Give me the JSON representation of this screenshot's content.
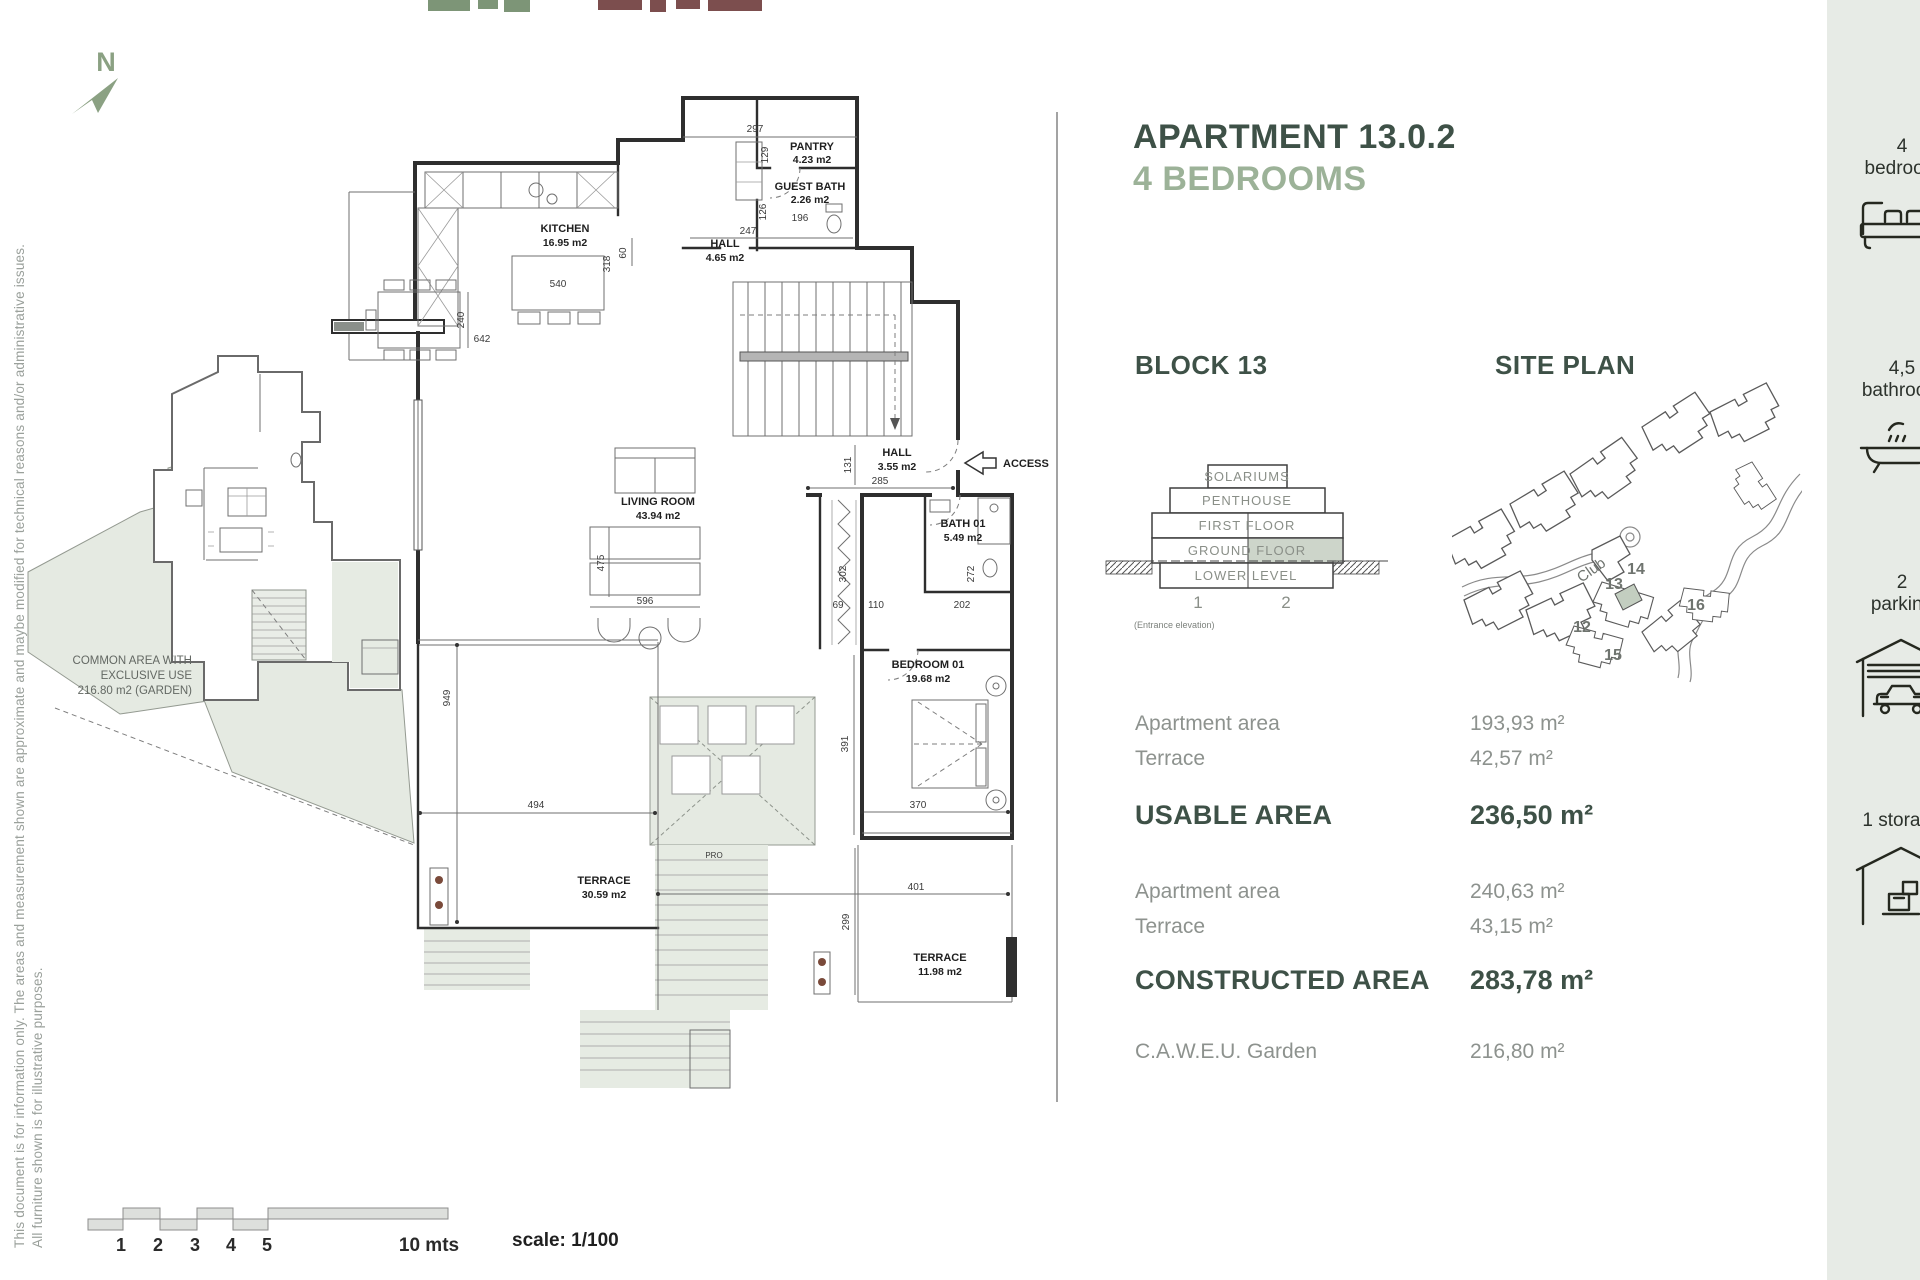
{
  "page": {
    "disclaimer_line1": "This document is for information only. The areas and measurement shown are approximate and maybe modified for technical reasons and/or administrative issues.",
    "disclaimer_line2": "All furniture shown is for illustrative purposes.",
    "compass_label": "N"
  },
  "header": {
    "title": "APARTMENT 13.0.2",
    "subtitle": "4 BEDROOMS"
  },
  "plan": {
    "rooms": [
      {
        "name": "PANTRY",
        "area": "4.23 m2"
      },
      {
        "name": "GUEST BATH",
        "area": "2.26 m2"
      },
      {
        "name": "KITCHEN",
        "area": "16.95 m2"
      },
      {
        "name": "HALL",
        "area": "4.65 m2"
      },
      {
        "name": "HALL",
        "area": "3.55 m2"
      },
      {
        "name": "LIVING ROOM",
        "area": "43.94 m2"
      },
      {
        "name": "BATH 01",
        "area": "5.49 m2"
      },
      {
        "name": "BEDROOM 01",
        "area": "19.68 m2"
      },
      {
        "name": "TERRACE",
        "area": "30.59 m2"
      },
      {
        "name": "TERRACE",
        "area": "11.98 m2"
      }
    ],
    "common_area": {
      "line1": "COMMON AREA WITH",
      "line2": "EXCLUSIVE USE",
      "line3": "216.80 m2 (GARDEN)"
    },
    "access_label": "ACCESS",
    "stair_label": "PRO",
    "dims": {
      "d297": "297",
      "d129": "129",
      "d126": "126",
      "d196": "196",
      "d247": "247",
      "d60": "60",
      "d540": "540",
      "d318": "318",
      "d642": "642",
      "d240": "240",
      "d475": "475",
      "d596": "596",
      "d131": "131",
      "d285": "285",
      "d302": "302",
      "d272": "272",
      "d69": "69",
      "d110": "110",
      "d202": "202",
      "d391": "391",
      "d370": "370",
      "d401": "401",
      "d299": "299",
      "d949": "949",
      "d494": "494"
    }
  },
  "block_section": {
    "heading": "BLOCK 13",
    "levels": [
      "SOLARIUMS",
      "PENTHOUSE",
      "FIRST FLOOR",
      "GROUND FLOOR",
      "LOWER LEVEL"
    ],
    "columns": [
      "1",
      "2"
    ],
    "caption": "(Entrance elevation)"
  },
  "site_section": {
    "heading": "SITE PLAN",
    "club_label": "Club",
    "block_numbers": [
      "12",
      "13",
      "14",
      "15",
      "16"
    ]
  },
  "areas": {
    "usable_rows": [
      {
        "label": "Apartment area",
        "value": "193,93 m²"
      },
      {
        "label": "Terrace",
        "value": "42,57 m²"
      }
    ],
    "usable_total": {
      "label": "USABLE AREA",
      "value": "236,50 m²"
    },
    "constructed_rows": [
      {
        "label": "Apartment area",
        "value": "240,63 m²"
      },
      {
        "label": "Terrace",
        "value": "43,15 m²"
      }
    ],
    "constructed_total": {
      "label": "CONSTRUCTED AREA",
      "value": "283,78 m²"
    },
    "garden_row": {
      "label": "C.A.W.E.U. Garden",
      "value": "216,80 m²"
    }
  },
  "amenities": [
    {
      "count": "4",
      "label": "bedroom"
    },
    {
      "count": "4,5",
      "label": "bathroom"
    },
    {
      "count": "2",
      "label": "parking"
    },
    {
      "count": "1 storage",
      "label": ""
    }
  ],
  "scalebar": {
    "ticks": [
      "1",
      "2",
      "3",
      "4",
      "5"
    ],
    "length_label": "10 mts",
    "scale_label": "scale: 1/100"
  }
}
